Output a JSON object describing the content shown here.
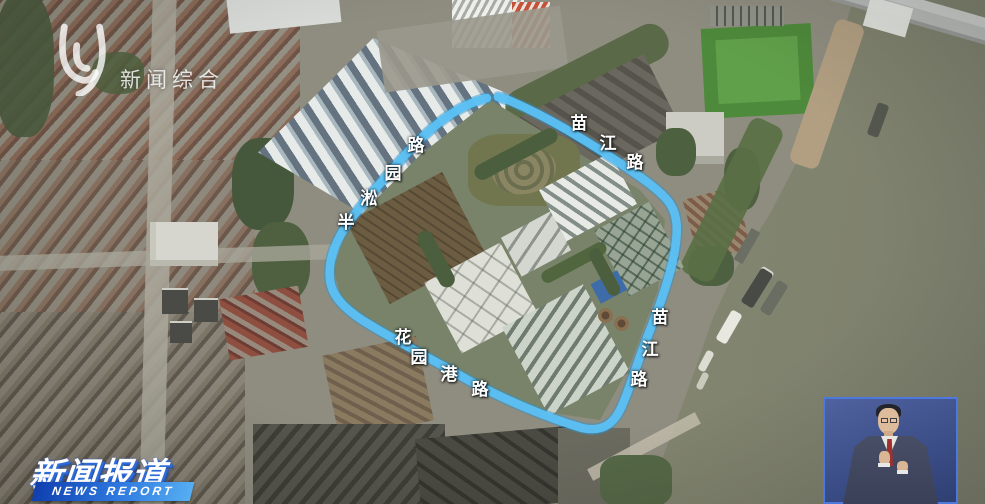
{
  "watermark": {
    "icon": "channel-logo",
    "label": "新闻综合"
  },
  "program_logo": {
    "title": "新闻报道",
    "subtitle": "NEWS REPORT",
    "ribbon_color": "#2f7ae0"
  },
  "map": {
    "type": "satellite",
    "route_color": "#5cc1f4",
    "roads": [
      {
        "name": "半淞园路",
        "chars": [
          "半",
          "淞",
          "园",
          "路"
        ]
      },
      {
        "name": "苗江路",
        "chars": [
          "苗",
          "江",
          "路"
        ]
      },
      {
        "name": "苗江路",
        "chars": [
          "苗",
          "江",
          "路"
        ]
      },
      {
        "name": "花园港路",
        "chars": [
          "花",
          "园",
          "港",
          "路"
        ]
      }
    ]
  },
  "interpreter": {
    "role": "sign-language-interpreter"
  }
}
